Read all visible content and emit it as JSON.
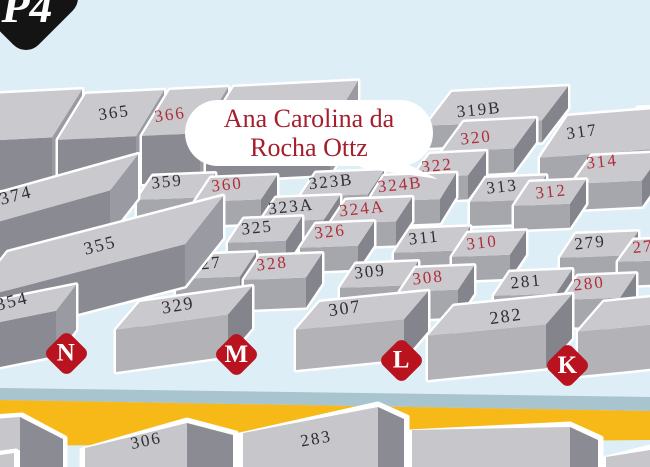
{
  "app": {
    "badge": "P4"
  },
  "tooltip": {
    "line1": "Ana Carolina da",
    "line2": "Rocha Ottz"
  },
  "markers": [
    {
      "label": "N"
    },
    {
      "label": "M"
    },
    {
      "label": "L"
    },
    {
      "label": "K"
    }
  ],
  "stalls": [
    {
      "id": "365",
      "label": "365",
      "color": "black"
    },
    {
      "id": "366",
      "label": "366",
      "color": "red"
    },
    {
      "id": "319B",
      "label": "319B",
      "color": "black"
    },
    {
      "id": "3",
      "label": "3",
      "color": "red"
    },
    {
      "id": "320",
      "label": "320",
      "color": "red"
    },
    {
      "id": "317",
      "label": "317",
      "color": "black"
    },
    {
      "id": "322",
      "label": "322",
      "color": "red"
    },
    {
      "id": "314",
      "label": "314",
      "color": "red"
    },
    {
      "id": "359",
      "label": "359",
      "color": "black"
    },
    {
      "id": "360",
      "label": "360",
      "color": "red"
    },
    {
      "id": "323B",
      "label": "323B",
      "color": "black"
    },
    {
      "id": "324B",
      "label": "324B",
      "color": "red"
    },
    {
      "id": "313",
      "label": "313",
      "color": "black"
    },
    {
      "id": "312",
      "label": "312",
      "color": "red"
    },
    {
      "id": "-374",
      "label": "-374",
      "color": "black"
    },
    {
      "id": "323A",
      "label": "323A",
      "color": "black"
    },
    {
      "id": "324A",
      "label": "324A",
      "color": "red"
    },
    {
      "id": "325",
      "label": "325",
      "color": "black"
    },
    {
      "id": "326",
      "label": "326",
      "color": "red"
    },
    {
      "id": "311",
      "label": "311",
      "color": "black"
    },
    {
      "id": "310",
      "label": "310",
      "color": "red"
    },
    {
      "id": "279",
      "label": "279",
      "color": "black"
    },
    {
      "id": "27",
      "label": "27",
      "color": "red"
    },
    {
      "id": "327",
      "label": "327",
      "color": "black"
    },
    {
      "id": "328",
      "label": "328",
      "color": "red"
    },
    {
      "id": "309",
      "label": "309",
      "color": "black"
    },
    {
      "id": "308",
      "label": "308",
      "color": "red"
    },
    {
      "id": "281",
      "label": "281",
      "color": "black"
    },
    {
      "id": "280",
      "label": "280",
      "color": "red"
    },
    {
      "id": "355",
      "label": "355",
      "color": "black"
    },
    {
      "id": "354",
      "label": "354",
      "color": "black"
    },
    {
      "id": "329",
      "label": "329",
      "color": "black"
    },
    {
      "id": "307",
      "label": "307",
      "color": "black"
    },
    {
      "id": "282",
      "label": "282",
      "color": "black"
    },
    {
      "id": "306",
      "label": "306",
      "color": "black"
    },
    {
      "id": "283",
      "label": "283",
      "color": "black"
    }
  ],
  "colors": {
    "sky": "#ddeef6",
    "top": "#c9c9ce",
    "front_light": "#b2b2b7",
    "front_mid": "#a6a6ad",
    "front_dark": "#8a8a92",
    "side": "#84848d",
    "side_light": "#9a9aa2",
    "left_face": "#7d7d87",
    "white": "#ffffff",
    "road_yellow": "#f6b917",
    "road_gray": "#a8c4cf",
    "label_black": "#2e2e36",
    "label_red": "#b02e3a",
    "marker_red": "#b8131f",
    "bubble_text": "#a41e2c",
    "badge_bg": "#141414"
  }
}
